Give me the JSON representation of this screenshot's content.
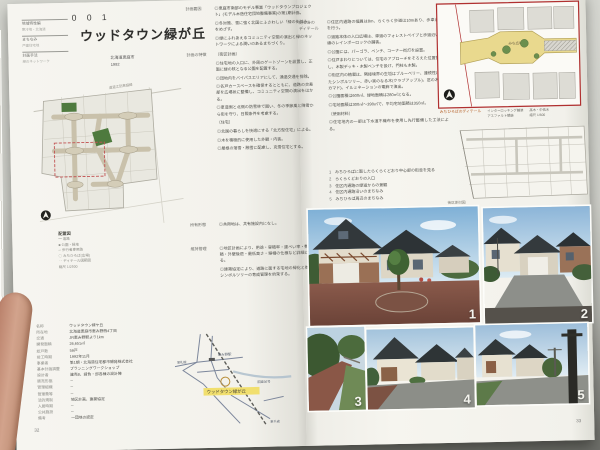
{
  "book": {
    "page_number_left": "32",
    "page_number_right": "33"
  },
  "left_page": {
    "index_tabs": [
      {
        "h": "地域特性編",
        "s": "寒冷地・北海道"
      },
      {
        "h": "まちなみ",
        "s": "戸建住宅地"
      },
      {
        "h": "計画手法",
        "s": "緑のネットワーク"
      }
    ],
    "title_block": {
      "number": "0 0 1",
      "title": "ウッドタウン緑が丘",
      "location": "北海道恵庭市",
      "year": "1992"
    },
    "sections": [
      {
        "label": "計画要因",
        "items": [
          "◎恵庭市南部のモデル事業「ウッドタウンプロジェクト」(モデル木造住宅団地整備事業)の第1期計画。",
          "◎冬対策、雪に強く北国にふさわしい「緑の街並み」をめざす。",
          "◎緑にふれあえるコミュニティ空間の演出と緑のネットワークによる潤いのあるまちづくり。"
        ]
      },
      {
        "label": "計画の特徴",
        "items": [
          "〔街区計画〕",
          "◎住宅地の入口に、外周のゲートゾーンを設置し、正面に緑の核となる公園を配置する。",
          "◎団地内をバイパスエリアにして、通過交通を排除。",
          "◎各戸カースペースを確保するとともに、道路の交差部を広場状に整備し、コミュニティ空間の演出をはかる。",
          "◎車道側と北側の防雪林で囲い、冬の季節風と降雪から街を守り、日照条件を考慮する。",
          "〔住宅〕",
          "◎北国の暮らしを快適にする「北方型住宅」による。",
          "◎木を積極的に使用した外観・内装。",
          "◎屋根の落雪・融雪に配慮し、克雪住宅とする。"
        ]
      },
      {
        "label": "所有形態",
        "items": [
          "◎共用地は、共有施設内になし。"
        ]
      },
      {
        "label": "維持管理",
        "items": [
          "◎地区計画により、用途・容積率・建ぺい率・敷地面積・外壁後退・最低高さ・塀柵の仕様など詳細に定める。",
          "◎建築協定により、道路に面する宅地の緑化と街路のシンボルツリーの育成管理を約束する。"
        ]
      }
    ],
    "site_plan": {
      "road_label": "道道江別恵庭線",
      "caption": "配置図",
      "legend": [
        "━ 道路",
        "■ 公園・緑地",
        "─ 歩行者専用路",
        "◯ みちひろば(広場)",
        "╌ ディテール図範囲",
        "縮尺 1/2500"
      ]
    },
    "spec_table": {
      "rows": [
        {
          "label": "名称",
          "value": "ウッドタウン緑ケ丘"
        },
        {
          "label": "所在地",
          "value": "北海道恵庭市恵み野西4丁目"
        },
        {
          "label": "交通",
          "value": "JR恵み野駅より1km"
        },
        {
          "label": "開発面積",
          "value": "26,651㎡"
        },
        {
          "label": "総戸数",
          "value": "59戸"
        },
        {
          "label": "竣工時期",
          "value": "1992年11月"
        },
        {
          "label": "事業者",
          "value": "第1期・北海道住宅都市開発株式会社"
        },
        {
          "label": "基本計画調整",
          "value": "プランニングワークショップ"
        },
        {
          "label": "設計者",
          "value": "建売8、請負・邸各棟の設計陣"
        },
        {
          "label": "販売形態",
          "value": "─"
        },
        {
          "label": "管理組織",
          "value": "─"
        },
        {
          "label": "管理費等",
          "value": "─"
        },
        {
          "label": "法的規制",
          "value": "地区計画、建築協定"
        },
        {
          "label": "入居時期",
          "value": "─"
        },
        {
          "label": "公共施設",
          "value": "─"
        },
        {
          "label": "備考",
          "value": "一団地の認定"
        }
      ]
    },
    "location_map": {
      "site": "ウッドタウン緑が丘",
      "station": "恵み野駅",
      "route": "国道36号",
      "to_sapporo": "至札幌",
      "to_chitose": "至千歳"
    }
  },
  "right_page": {
    "column_label_1": "街なみの",
    "column_label_2": "ディテール",
    "detail_items": [
      "◎住区内通路の幅員は8m、らくらく歩道は10mあり、歩車道分離を行う。",
      "◎道路本体の入口広場は、車道のフォレストペイブと歩道沿い一直線のレインボーロックの舗装。",
      "◎公園には、パーゴラ、ベンチ、コーナー街灯を設置。",
      "◎住戸まわりについては、住宅のアプローチをそろえた位置割りとし、木製デッキ・木製ベンチを設け、門柱も木製。",
      "◎街区内の植栽は、隣接境界の生垣はブルーベリー、連続性に優れたシンボルツリー、赤い実のなる木(クラブアップル)、窓の木(ナナカマド)、イルミネーションの電飾で演出。",
      "◎公園面積は600㎡、緑地面積は280㎡となる。",
      "◎宅地面積は300㎡〜390㎡で、平均宅地面積は350㎡。",
      "〔使用材料〕",
      "◎住宅地内の一部は下水道不織布を使用し先行整備した工法による。"
    ],
    "photo_captions": [
      {
        "num": "1",
        "caption": "みちひろばに面したらくらくどおり中心部の街並を見る"
      },
      {
        "num": "2",
        "caption": "らくらくどおりの入口"
      },
      {
        "num": "3",
        "caption": "住区内通路の緑道からの景観"
      },
      {
        "num": "4",
        "caption": "住区内通路沿いのまちなみ"
      },
      {
        "num": "5",
        "caption": "みちひろば周辺のまちなみ"
      }
    ],
    "detail_plan": {
      "plaza_label": "みち広場",
      "caption": "みちひろばのディテール",
      "legend_a1": "インターロッキング舗装",
      "legend_a2": "アスファルト舗装",
      "legend_b1": "高木・中低木",
      "legend_b2": "縮尺 1/600"
    },
    "plan2_label": "街区割付図"
  }
}
